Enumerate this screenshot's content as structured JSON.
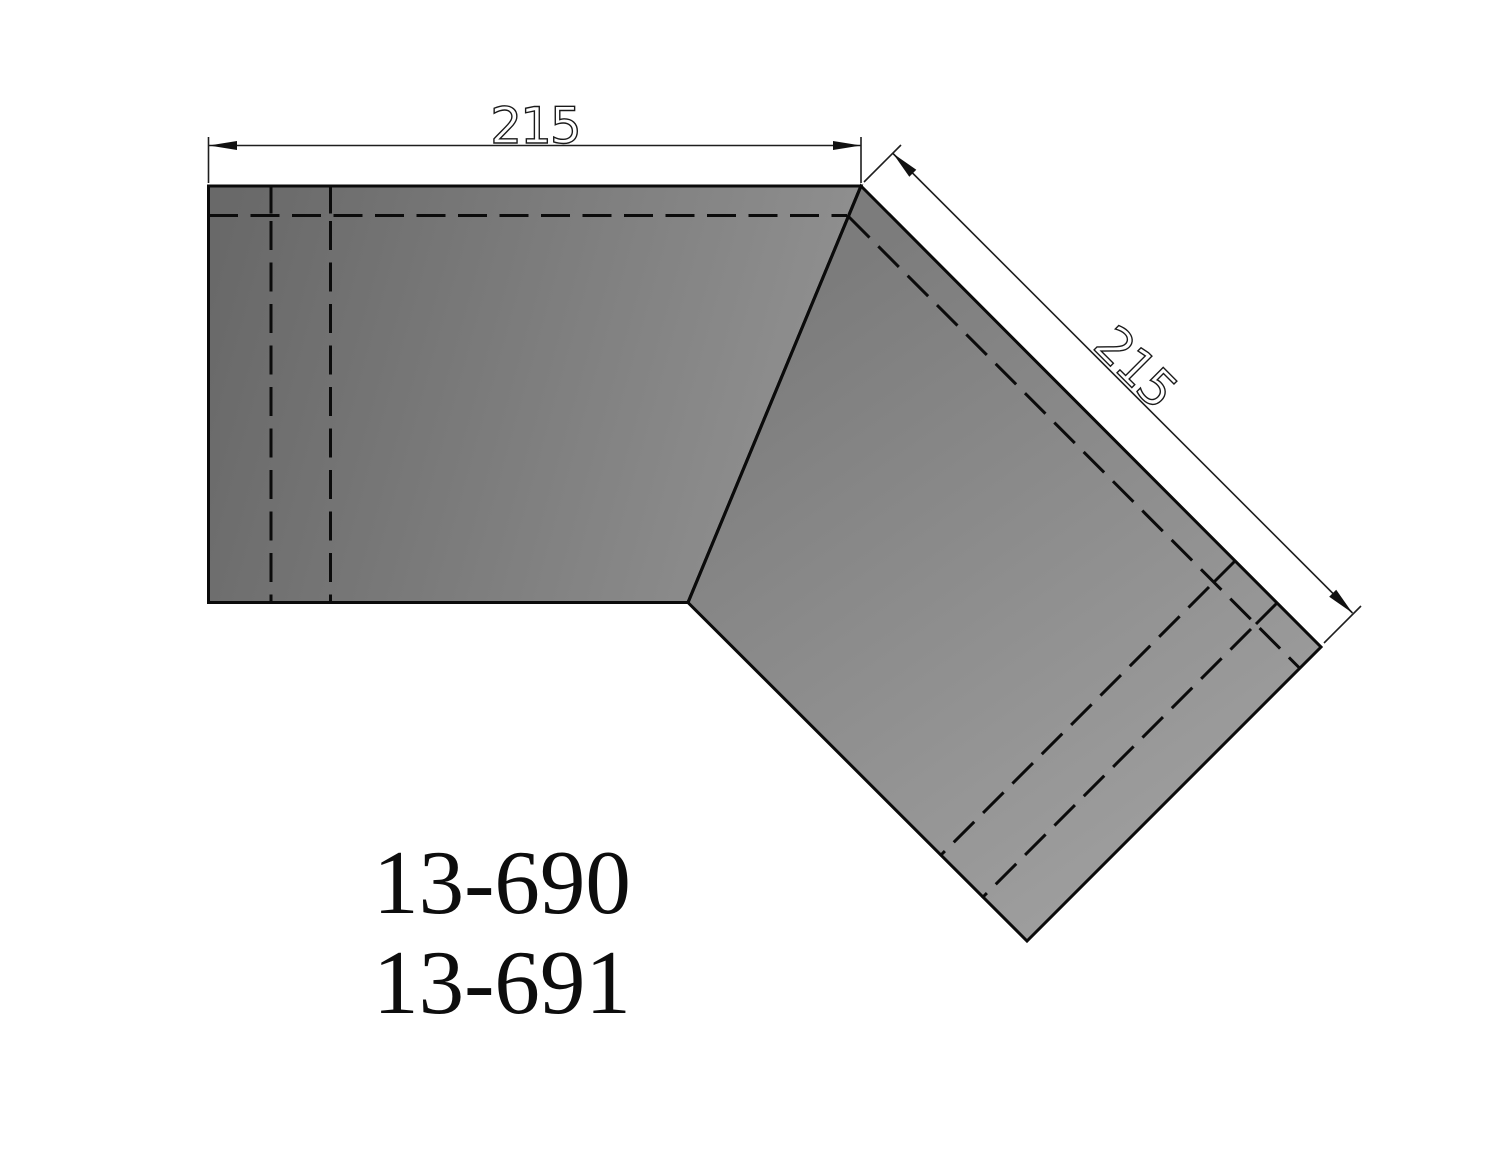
{
  "drawing": {
    "type": "mitered-corner-panel-technical-drawing",
    "dimensions": {
      "top_width": "215",
      "diagonal_width": "215"
    },
    "part_numbers": {
      "line1": "13-690",
      "line2": "13-691"
    }
  },
  "colors": {
    "background": "#ffffff",
    "line": "#0b0b0b",
    "dim_line": "#1e1e1e",
    "dim_text": "#1a1a1a",
    "part_text": "#0d0d0d",
    "panel_left_dark": "#696969",
    "panel_left_light": "#939393",
    "panel_right_dark": "#7c7c7c",
    "panel_right_light": "#9e9e9e"
  }
}
